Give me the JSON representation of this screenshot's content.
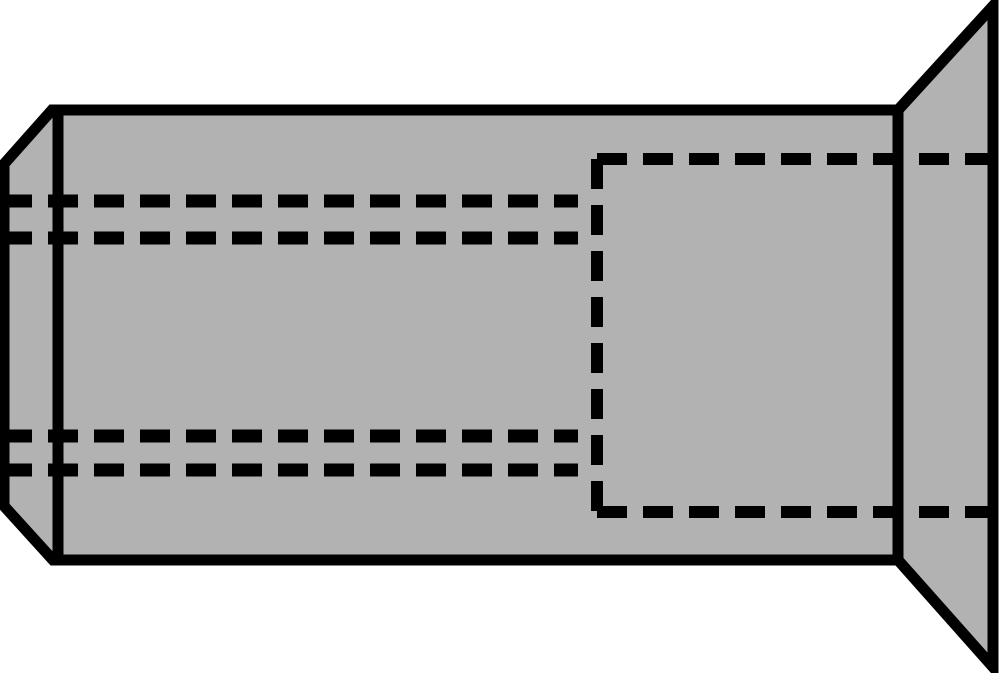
{
  "canvas": {
    "width": 1000,
    "height": 673,
    "background": "#ffffff"
  },
  "diagram": {
    "subject": "countersunk-blind-rivet-nut-side-view",
    "colors": {
      "part_fill": "#b2b2b2",
      "line": "#000000",
      "background": "#ffffff"
    },
    "outline_stroke_width": 11,
    "hidden_line_dash": "30 16",
    "shapes": [
      {
        "kind": "polygon",
        "name": "rivet-body-outline",
        "points": "52,110 898,110 898,560 53,560 4,506 4,164",
        "fill": "part",
        "stroke_width": 11
      },
      {
        "kind": "polygon",
        "name": "countersunk-head-outline",
        "points": "898,110 993,6 993,667 898,560",
        "fill": "part",
        "stroke_width": 11
      },
      {
        "kind": "line",
        "name": "chamfer-tangent-line",
        "x1": 58,
        "y1": 110,
        "x2": 58,
        "y2": 560,
        "stroke_width": 11
      },
      {
        "kind": "line",
        "name": "thread-upper-outer-hidden-line",
        "x1": 2,
        "y1": 201,
        "x2": 578,
        "y2": 201,
        "stroke_width": 13,
        "dashed": true
      },
      {
        "kind": "line",
        "name": "thread-upper-inner-hidden-line",
        "x1": 2,
        "y1": 238,
        "x2": 578,
        "y2": 238,
        "stroke_width": 13,
        "dashed": true
      },
      {
        "kind": "line",
        "name": "thread-lower-inner-hidden-line",
        "x1": 2,
        "y1": 436,
        "x2": 578,
        "y2": 436,
        "stroke_width": 13,
        "dashed": true
      },
      {
        "kind": "line",
        "name": "thread-lower-outer-hidden-line",
        "x1": 2,
        "y1": 470,
        "x2": 578,
        "y2": 470,
        "stroke_width": 13,
        "dashed": true
      },
      {
        "kind": "line",
        "name": "bore-top-hidden-line",
        "x1": 597,
        "y1": 159,
        "x2": 993,
        "y2": 159,
        "stroke_width": 12,
        "dashed": true
      },
      {
        "kind": "line",
        "name": "bore-left-hidden-line",
        "x1": 597,
        "y1": 159,
        "x2": 597,
        "y2": 512,
        "stroke_width": 12,
        "dashed": true
      },
      {
        "kind": "line",
        "name": "bore-bottom-hidden-line",
        "x1": 597,
        "y1": 512,
        "x2": 993,
        "y2": 512,
        "stroke_width": 12,
        "dashed": true
      }
    ]
  }
}
